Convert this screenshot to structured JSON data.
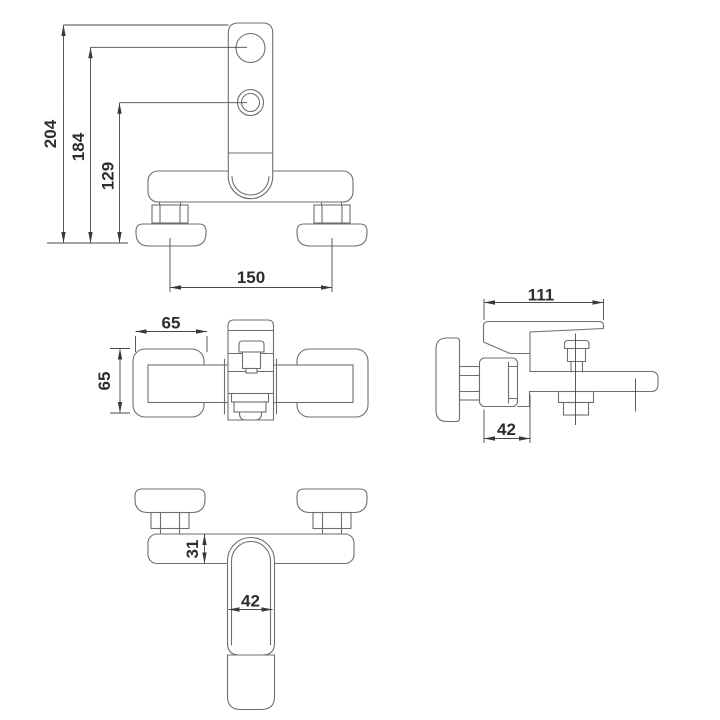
{
  "document": {
    "kind": "technical dimension drawing",
    "subject": "wall-mounted bath mixer faucet, four orthographic views",
    "background": "#ffffff"
  },
  "colors": {
    "object_lines": "#6f6f6f",
    "dimension_lines": "#4a4a4a",
    "arrowheads": "#3a3a3a",
    "label_text": "#2d2d2d"
  },
  "views": {
    "front": {
      "label": "front view",
      "dims": {
        "overall_height": "204",
        "upper_hole_height": "184",
        "lower_hole_height": "129",
        "hole_spacing": "150"
      }
    },
    "top": {
      "label": "top view",
      "dims": {
        "width": "65",
        "depth": "65"
      }
    },
    "side": {
      "label": "side view",
      "dims": {
        "overall_depth": "111",
        "body_depth": "42"
      }
    },
    "bottom": {
      "label": "bottom view",
      "dims": {
        "body_height": "31",
        "handle_width": "42"
      }
    }
  }
}
